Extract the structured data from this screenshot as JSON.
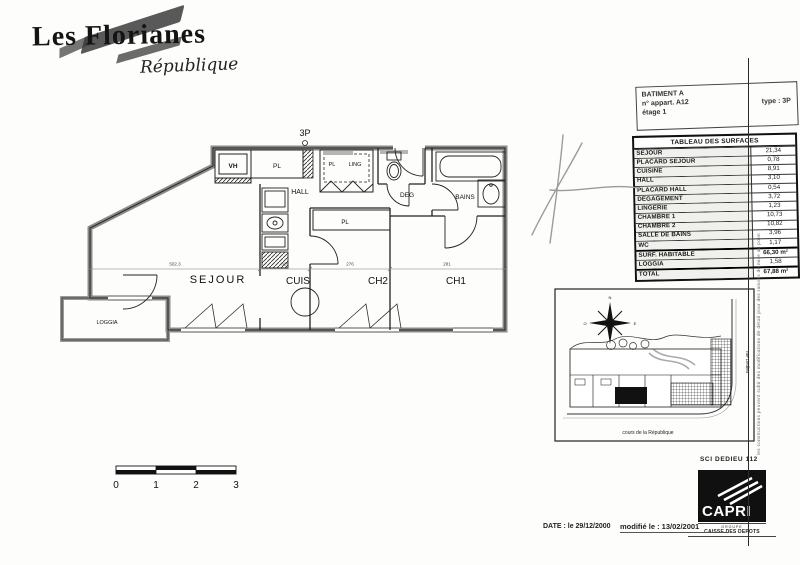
{
  "logo": {
    "title": "Les Florianes",
    "subtitle": "République"
  },
  "info_box": {
    "line1": "BATIMENT A",
    "line2": "n° appart. A12",
    "line3": "étage 1",
    "type": "type : 3P"
  },
  "surface_table": {
    "title": "TABLEAU DES SURFACES",
    "rows": [
      {
        "label": "SEJOUR",
        "value": "21,34"
      },
      {
        "label": "PLACARD SEJOUR",
        "value": "0,78"
      },
      {
        "label": "CUISINE",
        "value": "8,91"
      },
      {
        "label": "HALL",
        "value": "3,10"
      },
      {
        "label": "PLACARD HALL",
        "value": "0,54"
      },
      {
        "label": "DEGAGEMENT",
        "value": "3,72"
      },
      {
        "label": "LINGERIE",
        "value": "1,23"
      },
      {
        "label": "CHAMBRE 1",
        "value": "10,73"
      },
      {
        "label": "CHAMBRE 2",
        "value": "10,82"
      },
      {
        "label": "SALLE DE BAINS",
        "value": "3,96"
      },
      {
        "label": "WC",
        "value": "1,17"
      },
      {
        "label": "SURF. HABITABLE",
        "value": "66,30 m²"
      },
      {
        "label": "LOGGIA",
        "value": "1,58"
      },
      {
        "label": "TOTAL",
        "value": "67,88 m²"
      }
    ]
  },
  "floor_plan": {
    "type_label": "3P",
    "rooms": {
      "vh": "VH",
      "pl_top": "PL",
      "pl_ling": "PL",
      "ling": "LING",
      "hall": "HALL",
      "deg": "DEG",
      "bains": "BAINS",
      "pl_ch2": "PL",
      "sejour": "SEJOUR",
      "cuis": "CUIS",
      "ch2": "CH2",
      "ch1": "CH1",
      "loggia": "LOGGIA"
    },
    "dims": [
      "502.3",
      "325",
      "276",
      "281"
    ]
  },
  "site_plan": {
    "street_bottom": "cours de la République",
    "street_right": "rue Dedieu",
    "compass": {
      "n": "N",
      "s": "S",
      "e": "E",
      "o": "O"
    }
  },
  "scale_bar": {
    "ticks": [
      "0",
      "1",
      "2",
      "3"
    ]
  },
  "footer": {
    "date": "DATE : le 29/12/2000",
    "modified": "modifié le : 13/02/2001"
  },
  "branding": {
    "sci": "SCI DEDIEU 112",
    "capri": "CAPRI",
    "groupe": "GROUPE",
    "caisse": "CAISSE DES DEPOTS"
  },
  "side_note": "les constructions peuvent subir des modifications de détail pour des raisons de mise au point",
  "colors": {
    "ink": "#1a1a1a",
    "wall": "#8a8a8a",
    "pencil": "#9b9b9b",
    "paper": "#fdfdfc"
  }
}
